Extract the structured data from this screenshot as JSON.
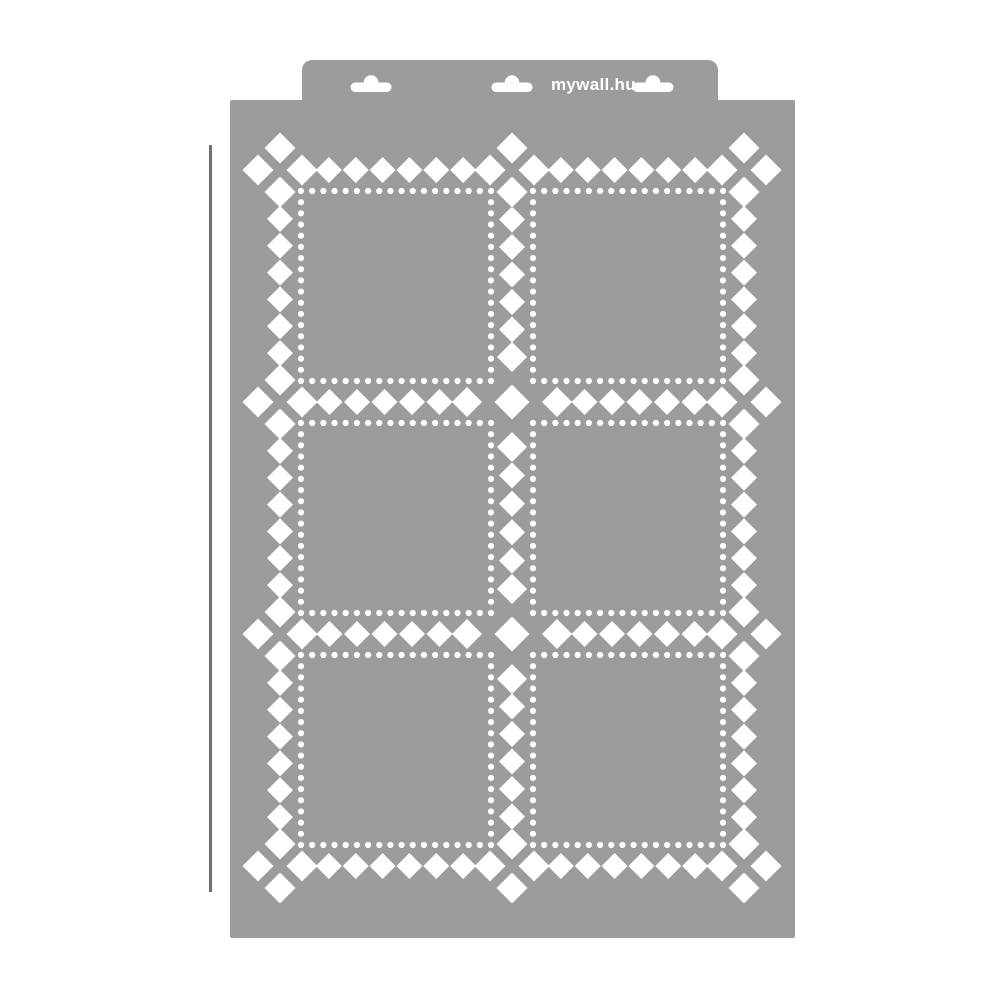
{
  "scene": {
    "width": 1001,
    "height": 1000,
    "background_color": "#ffffff"
  },
  "product": {
    "kind": "wall-stencil-sheet",
    "brand_label": "mywall.hu",
    "panel_rows": 3,
    "panel_cols": 2
  },
  "colors": {
    "stencil_gray": "#9c9c9c",
    "cutout_white": "#ffffff",
    "reference_line": "#707070",
    "brand_text": "#ffffff"
  },
  "header": {
    "x": 302,
    "y": 60,
    "width": 416,
    "height": 42,
    "corner_radius": 10,
    "hang_slots": {
      "centers_x": [
        371,
        512,
        653
      ],
      "pill_y": 82.5,
      "pill_width": 41,
      "pill_height": 9.5,
      "pill_radius": 4.75,
      "bump_radius": 7.3
    },
    "brand_pos": {
      "x": 551,
      "y": 90
    }
  },
  "sheet": {
    "x": 230,
    "y": 100,
    "width": 565,
    "height": 838,
    "corner_radius": 2
  },
  "reference_line": {
    "x": 209,
    "y1": 145,
    "y2": 892,
    "stroke_width": 3
  },
  "pattern": {
    "band_xs": [
      280,
      512,
      744
    ],
    "band_ys": [
      170,
      402,
      634,
      866
    ],
    "cross_nodes": [
      [
        1,
        1
      ],
      [
        1,
        2
      ]
    ],
    "tight_offset": 22,
    "tight_half": 15.5,
    "cross_center_half": 17.5,
    "cross_offset": 45,
    "cross_half": 15,
    "fill_half": 13,
    "fill_spacing": 27.5,
    "panels": {
      "col_ranges": [
        [
          301,
          491
        ],
        [
          533,
          723
        ]
      ],
      "row_ranges": [
        [
          191,
          381
        ],
        [
          423,
          613
        ],
        [
          655,
          845
        ]
      ],
      "dots_per_side": 18,
      "dot_radius": 3.1
    }
  }
}
